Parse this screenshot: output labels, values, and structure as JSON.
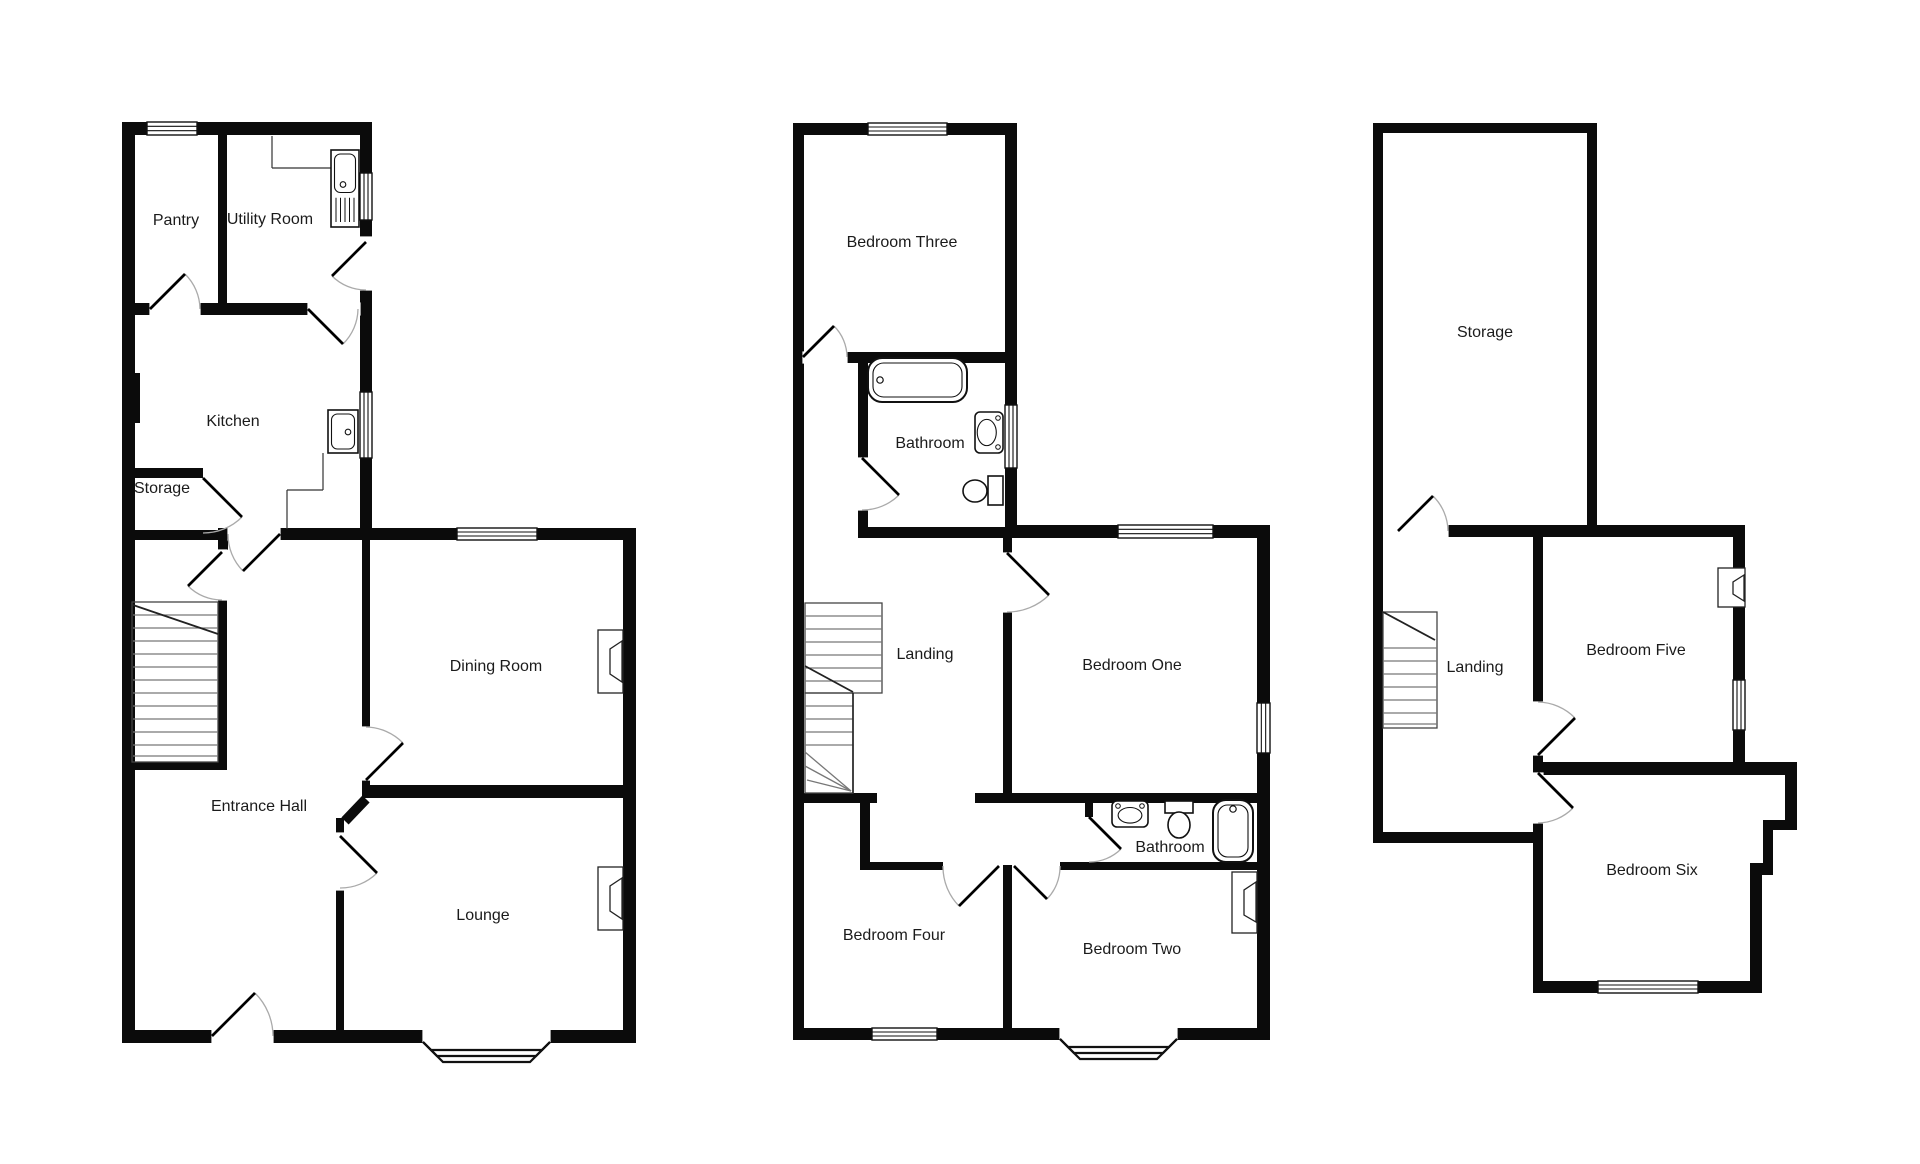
{
  "canvas": {
    "w": 1920,
    "h": 1164,
    "bg": "#ffffff"
  },
  "style": {
    "wall_color": "#0b0b0b",
    "door_leaf_color": "#000000",
    "door_arc_color": "#aaaaaa",
    "stair_tread_color": "#777777",
    "stair_outline_color": "#444444",
    "fixture_color": "#111111",
    "label_color": "#1b1b1b",
    "label_size": 16
  },
  "floors": [
    {
      "id": "ground-floor",
      "labels": [
        {
          "text": "Pantry",
          "x": 176,
          "y": 221
        },
        {
          "text": "Utility Room",
          "x": 270,
          "y": 220
        },
        {
          "text": "Kitchen",
          "x": 233,
          "y": 422
        },
        {
          "text": "Storage",
          "x": 162,
          "y": 489
        },
        {
          "text": "Entrance Hall",
          "x": 259,
          "y": 807
        },
        {
          "text": "Dining Room",
          "x": 496,
          "y": 667
        },
        {
          "text": "Lounge",
          "x": 483,
          "y": 916
        }
      ],
      "walls": [
        [
          122,
          122,
          13,
          921
        ],
        [
          122,
          122,
          250,
          13
        ],
        [
          360,
          122,
          12,
          418
        ],
        [
          360,
          528,
          276,
          12
        ],
        [
          623,
          528,
          13,
          515
        ],
        [
          122,
          1030,
          514,
          13
        ],
        [
          122,
          373,
          18,
          50
        ],
        [
          218,
          135,
          9,
          170
        ],
        [
          135,
          303,
          225,
          12
        ],
        [
          135,
          468,
          68,
          10
        ],
        [
          135,
          530,
          95,
          10
        ],
        [
          228,
          528,
          144,
          12
        ],
        [
          218,
          528,
          10,
          22
        ],
        [
          218,
          600,
          9,
          170
        ],
        [
          132,
          762,
          95,
          8
        ],
        [
          362,
          540,
          8,
          187
        ],
        [
          362,
          780,
          8,
          18
        ],
        [
          367,
          785,
          269,
          13
        ],
        [
          336,
          818,
          8,
          212
        ]
      ],
      "wall_lines": [
        [
          366,
          799,
          345,
          821,
          10
        ]
      ],
      "openings": [
        [
          150,
          303,
          50,
          12
        ],
        [
          308,
          303,
          52,
          12
        ],
        [
          360,
          237,
          12,
          53
        ],
        [
          228,
          528,
          52,
          12
        ],
        [
          218,
          550,
          9,
          50
        ],
        [
          362,
          727,
          8,
          53
        ],
        [
          336,
          833,
          8,
          57
        ],
        [
          212,
          1030,
          61,
          13
        ],
        [
          423,
          1030,
          127,
          13
        ]
      ],
      "windows": [
        [
          147,
          122,
          50,
          13
        ],
        [
          360,
          173,
          12,
          47
        ],
        [
          360,
          392,
          12,
          66
        ],
        [
          457,
          528,
          80,
          12
        ]
      ],
      "bays": [
        {
          "x1": 423,
          "x2": 550,
          "y": 1042,
          "depths": [
            20,
            14,
            8
          ]
        }
      ],
      "doors": [
        {
          "leaf": [
            150,
            309,
            185,
            274
          ],
          "arc": [
            185,
            274,
            200,
            309,
            50,
            1
          ]
        },
        {
          "leaf": [
            308,
            309,
            343,
            344
          ],
          "arc": [
            343,
            344,
            358,
            309,
            50,
            0
          ]
        },
        {
          "leaf": [
            366,
            242,
            332,
            276
          ],
          "arc": [
            332,
            276,
            366,
            290,
            48,
            0
          ]
        },
        {
          "leaf": [
            203,
            478,
            242,
            517
          ],
          "arc": [
            242,
            517,
            203,
            533,
            55,
            1
          ]
        },
        {
          "leaf": [
            280,
            534,
            243,
            571
          ],
          "arc": [
            243,
            571,
            228,
            534,
            52,
            1
          ]
        },
        {
          "leaf": [
            222,
            552,
            188,
            586
          ],
          "arc": [
            188,
            586,
            222,
            600,
            48,
            0
          ]
        },
        {
          "leaf": [
            366,
            780,
            403,
            743
          ],
          "arc": [
            403,
            743,
            366,
            727,
            53,
            0
          ]
        },
        {
          "leaf": [
            340,
            836,
            377,
            873
          ],
          "arc": [
            377,
            873,
            340,
            888,
            52,
            1
          ]
        },
        {
          "leaf": [
            212,
            1036,
            255,
            993
          ],
          "arc": [
            255,
            993,
            273,
            1036,
            61,
            1
          ]
        }
      ],
      "stairs": [
        {
          "outline": [
            132,
            602,
            86,
            160
          ],
          "tx": [
            133,
            218
          ],
          "ty": [
            615,
            628,
            641,
            654,
            667,
            680,
            693,
            706,
            719,
            732,
            745,
            756
          ],
          "brk": [
            133,
            605,
            218,
            634
          ]
        }
      ],
      "fireplaces": [
        {
          "rect": [
            598,
            630,
            25,
            63
          ],
          "trap": [
            [
              622,
              641
            ],
            [
              610,
              649
            ],
            [
              610,
              674
            ],
            [
              622,
              682
            ]
          ]
        },
        {
          "rect": [
            598,
            867,
            25,
            63
          ],
          "trap": [
            [
              622,
              878
            ],
            [
              610,
              886
            ],
            [
              610,
              911
            ],
            [
              622,
              919
            ]
          ]
        }
      ],
      "thin_lines": [
        [
          272,
          136,
          272,
          168
        ],
        [
          272,
          168,
          331,
          168
        ],
        [
          323,
          453,
          323,
          490
        ],
        [
          287,
          490,
          323,
          490
        ],
        [
          287,
          490,
          287,
          529
        ]
      ],
      "fixtures": [
        {
          "type": "sink_drainer",
          "rect": [
            331,
            150,
            28,
            77
          ]
        },
        {
          "type": "sink",
          "rect": [
            328,
            410,
            30,
            43
          ],
          "dot": [
            348,
            432
          ]
        }
      ]
    },
    {
      "id": "first-floor",
      "labels": [
        {
          "text": "Bedroom Three",
          "x": 902,
          "y": 243
        },
        {
          "text": "Bathroom",
          "x": 930,
          "y": 444
        },
        {
          "text": "Landing",
          "x": 925,
          "y": 655
        },
        {
          "text": "Bedroom One",
          "x": 1132,
          "y": 666
        },
        {
          "text": "Bedroom Four",
          "x": 894,
          "y": 936
        },
        {
          "text": "Bedroom Two",
          "x": 1132,
          "y": 950
        },
        {
          "text": "Bathroom",
          "x": 1170,
          "y": 848
        }
      ],
      "walls": [
        [
          793,
          123,
          11,
          917
        ],
        [
          793,
          123,
          224,
          12
        ],
        [
          1005,
          123,
          12,
          415
        ],
        [
          1005,
          525,
          265,
          13
        ],
        [
          1257,
          525,
          13,
          515
        ],
        [
          793,
          1028,
          477,
          12
        ],
        [
          803,
          352,
          202,
          11
        ],
        [
          858,
          352,
          10,
          186
        ],
        [
          858,
          527,
          147,
          11
        ],
        [
          1003,
          538,
          9,
          255
        ],
        [
          975,
          793,
          292,
          10
        ],
        [
          793,
          793,
          84,
          10
        ],
        [
          860,
          800,
          10,
          67
        ],
        [
          860,
          862,
          83,
          8
        ],
        [
          1003,
          865,
          9,
          163
        ],
        [
          1060,
          862,
          203,
          8
        ],
        [
          1085,
          803,
          8,
          14
        ]
      ],
      "wall_lines": [],
      "openings": [
        [
          803,
          352,
          44,
          11
        ],
        [
          858,
          458,
          10,
          52
        ],
        [
          1003,
          553,
          9,
          59
        ],
        [
          1060,
          1028,
          117,
          12
        ]
      ],
      "windows": [
        [
          868,
          123,
          79,
          12
        ],
        [
          1005,
          405,
          12,
          63
        ],
        [
          1118,
          525,
          95,
          13
        ],
        [
          1257,
          703,
          13,
          50
        ],
        [
          872,
          1028,
          65,
          12
        ]
      ],
      "bays": [
        {
          "x1": 1060,
          "x2": 1177,
          "y": 1039,
          "depths": [
            20,
            14,
            8
          ]
        }
      ],
      "doors": [
        {
          "leaf": [
            803,
            357,
            834,
            326
          ],
          "arc": [
            834,
            326,
            847,
            357,
            44,
            1
          ]
        },
        {
          "leaf": [
            862,
            458,
            899,
            495
          ],
          "arc": [
            899,
            495,
            862,
            510,
            52,
            1
          ]
        },
        {
          "leaf": [
            1007,
            553,
            1049,
            595
          ],
          "arc": [
            1049,
            595,
            1007,
            612,
            59,
            1
          ]
        },
        {
          "leaf": [
            999,
            866,
            959,
            906
          ],
          "arc": [
            959,
            906,
            943,
            866,
            56,
            1
          ]
        },
        {
          "leaf": [
            1014,
            866,
            1047,
            899
          ],
          "arc": [
            1047,
            899,
            1060,
            866,
            46,
            0
          ]
        },
        {
          "leaf": [
            1089,
            817,
            1121,
            849
          ],
          "arc": [
            1121,
            849,
            1089,
            862,
            45,
            1
          ]
        }
      ],
      "stairs": [
        {
          "outline": [
            805,
            603,
            77,
            90
          ],
          "tx": [
            805,
            882
          ],
          "ty": [
            616,
            629,
            642,
            655,
            668,
            681
          ],
          "brk": [
            805,
            666,
            853,
            692
          ]
        },
        {
          "outline": [
            805,
            693,
            48,
            100
          ],
          "tx": [
            805,
            853
          ],
          "ty": [
            706,
            719,
            732,
            745
          ],
          "fan": [
            [
              851,
              791,
              805,
              752
            ],
            [
              851,
              791,
              805,
              766
            ],
            [
              851,
              791,
              807,
              780
            ]
          ],
          "div": [
            853,
            693,
            853,
            793
          ]
        }
      ],
      "fireplaces": [
        {
          "rect": [
            1232,
            872,
            25,
            61
          ],
          "trap": [
            [
              1256,
              882
            ],
            [
              1244,
              890
            ],
            [
              1244,
              915
            ],
            [
              1256,
              922
            ]
          ]
        }
      ],
      "thin_lines": [],
      "fixtures": [
        {
          "type": "bath",
          "rect": [
            868,
            358,
            99,
            44
          ],
          "tap": "left"
        },
        {
          "type": "basin",
          "rect": [
            975,
            412,
            28,
            41
          ],
          "wall": "right"
        },
        {
          "type": "toilet",
          "cistern": [
            988,
            476,
            15,
            29
          ],
          "bowl": [
            975,
            491,
            12,
            11
          ]
        },
        {
          "type": "basin",
          "rect": [
            1112,
            801,
            36,
            26
          ],
          "wall": "top"
        },
        {
          "type": "toilet",
          "cistern": [
            1165,
            801,
            28,
            12
          ],
          "bowl": [
            1179,
            825,
            11,
            13
          ]
        },
        {
          "type": "bath",
          "rect": [
            1213,
            800,
            40,
            62
          ],
          "tap": "top"
        }
      ]
    },
    {
      "id": "second-floor",
      "labels": [
        {
          "text": "Storage",
          "x": 1485,
          "y": 333
        },
        {
          "text": "Landing",
          "x": 1475,
          "y": 668
        },
        {
          "text": "Bedroom Five",
          "x": 1636,
          "y": 651
        },
        {
          "text": "Bedroom Six",
          "x": 1652,
          "y": 871
        }
      ],
      "walls": [
        [
          1373,
          123,
          10,
          720
        ],
        [
          1373,
          123,
          224,
          10
        ],
        [
          1587,
          123,
          10,
          414
        ],
        [
          1395,
          525,
          350,
          12
        ],
        [
          1733,
          525,
          12,
          250
        ],
        [
          1533,
          537,
          10,
          306
        ],
        [
          1543,
          762,
          254,
          13
        ],
        [
          1785,
          762,
          12,
          68
        ],
        [
          1763,
          820,
          34,
          10
        ],
        [
          1763,
          820,
          10,
          55
        ],
        [
          1750,
          863,
          23,
          12
        ],
        [
          1750,
          863,
          12,
          130
        ],
        [
          1533,
          843,
          10,
          150
        ],
        [
          1373,
          832,
          170,
          11
        ],
        [
          1533,
          981,
          229,
          12
        ]
      ],
      "wall_lines": [],
      "openings": [
        [
          1395,
          525,
          53,
          12
        ],
        [
          1533,
          702,
          10,
          53
        ],
        [
          1533,
          773,
          10,
          50
        ]
      ],
      "windows": [
        [
          1733,
          680,
          12,
          50
        ],
        [
          1598,
          981,
          100,
          12
        ]
      ],
      "bays": [],
      "doors": [
        {
          "leaf": [
            1398,
            531,
            1433,
            496
          ],
          "arc": [
            1433,
            496,
            1448,
            531,
            50,
            1
          ]
        },
        {
          "leaf": [
            1538,
            755,
            1575,
            718
          ],
          "arc": [
            1575,
            718,
            1538,
            702,
            53,
            0
          ]
        },
        {
          "leaf": [
            1538,
            773,
            1573,
            808
          ],
          "arc": [
            1573,
            808,
            1538,
            823,
            50,
            1
          ]
        }
      ],
      "stairs": [
        {
          "outline": [
            1383,
            612,
            54,
            116
          ],
          "tx": [
            1383,
            1437
          ],
          "ty": [
            648,
            661,
            674,
            687,
            700,
            713,
            724
          ],
          "brk": [
            1383,
            612,
            1435,
            640
          ]
        }
      ],
      "fireplaces": [
        {
          "rect": [
            1718,
            568,
            27,
            39
          ],
          "trap": [
            [
              1744,
              575
            ],
            [
              1733,
              582
            ],
            [
              1733,
              594
            ],
            [
              1744,
              601
            ]
          ]
        }
      ],
      "thin_lines": [],
      "fixtures": []
    }
  ]
}
